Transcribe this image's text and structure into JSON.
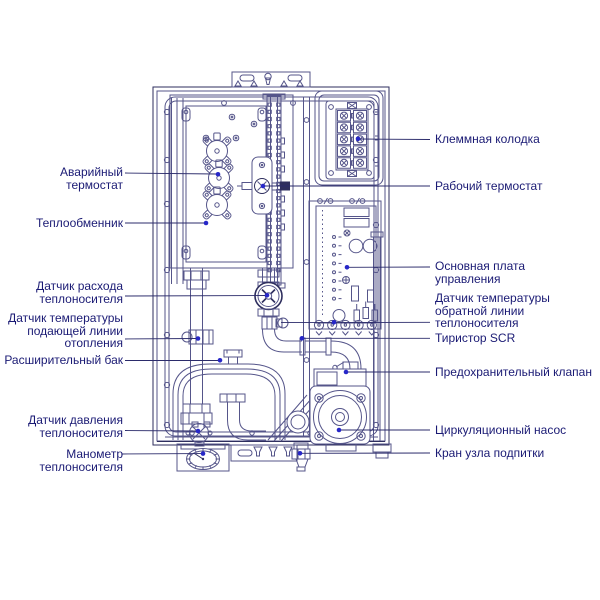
{
  "diagram_type": "boiler-internal-components-schematic",
  "colors": {
    "label_text": "#1a1a74",
    "diagram_line": "#55558a",
    "diagram_line_dark": "#2e2e5e",
    "leader_line": "#2b2b6b",
    "pointer_dot": "#2727c8",
    "background": "#ffffff"
  },
  "labels": {
    "left": [
      {
        "id": "emergency-thermostat",
        "text": "Аварийный термостат"
      },
      {
        "id": "heat-exchanger",
        "text": "Теплообменник"
      },
      {
        "id": "coolant-flow-sensor",
        "text": "Датчик расхода теплоносителя"
      },
      {
        "id": "supply-line-temp-sensor",
        "text": "Датчик температуры подающей линии отопления"
      },
      {
        "id": "expansion-tank",
        "text": "Расширительный бак"
      },
      {
        "id": "coolant-pressure-sensor",
        "text": "Датчик давления теплоносителя"
      },
      {
        "id": "coolant-manometer",
        "text": "Манометр теплоносителя"
      }
    ],
    "right": [
      {
        "id": "terminal-block",
        "text": "Клеммная колодка"
      },
      {
        "id": "working-thermostat",
        "text": "Рабочий термостат"
      },
      {
        "id": "main-control-board",
        "text": "Основная плата управления"
      },
      {
        "id": "return-line-temp-sensor",
        "text": "Датчик температуры обратной линии теплоносителя"
      },
      {
        "id": "scr-thyristor",
        "text": "Тиристор SCR"
      },
      {
        "id": "safety-valve",
        "text": "Предохранительный клапан"
      },
      {
        "id": "circulation-pump",
        "text": "Циркуляционный насос"
      },
      {
        "id": "makeup-valve",
        "text": "Кран узла подпитки"
      }
    ]
  }
}
